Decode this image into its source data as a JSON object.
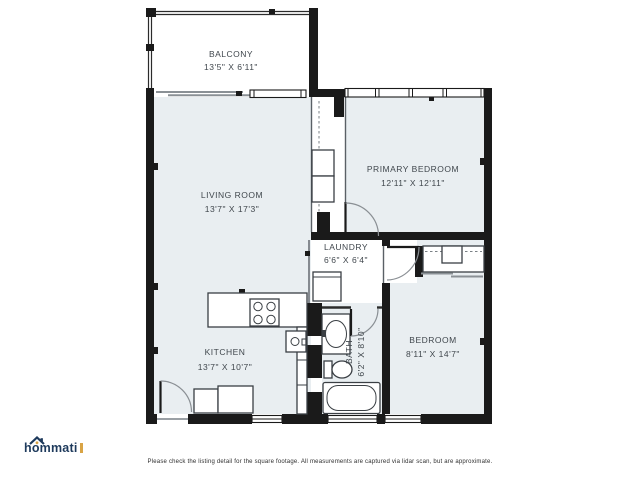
{
  "branding": {
    "logo_text": "hommati"
  },
  "footer": {
    "disclaimer": "Please check the listing detail for the square footage. All measurements are captured via lidar scan, but are approximate."
  },
  "floorplan": {
    "colors": {
      "room_fill": "#e9eef1",
      "wall": "#1a1a1a",
      "label": "#40474d",
      "logo_navy": "#1e3a5c",
      "logo_orange": "#d9a445"
    },
    "rooms": {
      "balcony": {
        "name": "BALCONY",
        "dims": "13'5\" X 6'11\""
      },
      "living_room": {
        "name": "LIVING ROOM",
        "dims": "13'7\" X 17'3\""
      },
      "primary_bedroom": {
        "name": "PRIMARY BEDROOM",
        "dims": "12'11\" X 12'11\""
      },
      "laundry": {
        "name": "LAUNDRY",
        "dims": "6'6\" X 6'4\""
      },
      "kitchen": {
        "name": "KITCHEN",
        "dims": "13'7\" X 10'7\""
      },
      "bath": {
        "name": "BATH",
        "dims": "6'2\" X 8'10\""
      },
      "bedroom": {
        "name": "BEDROOM",
        "dims": "8'11\" X 14'7\""
      }
    }
  }
}
